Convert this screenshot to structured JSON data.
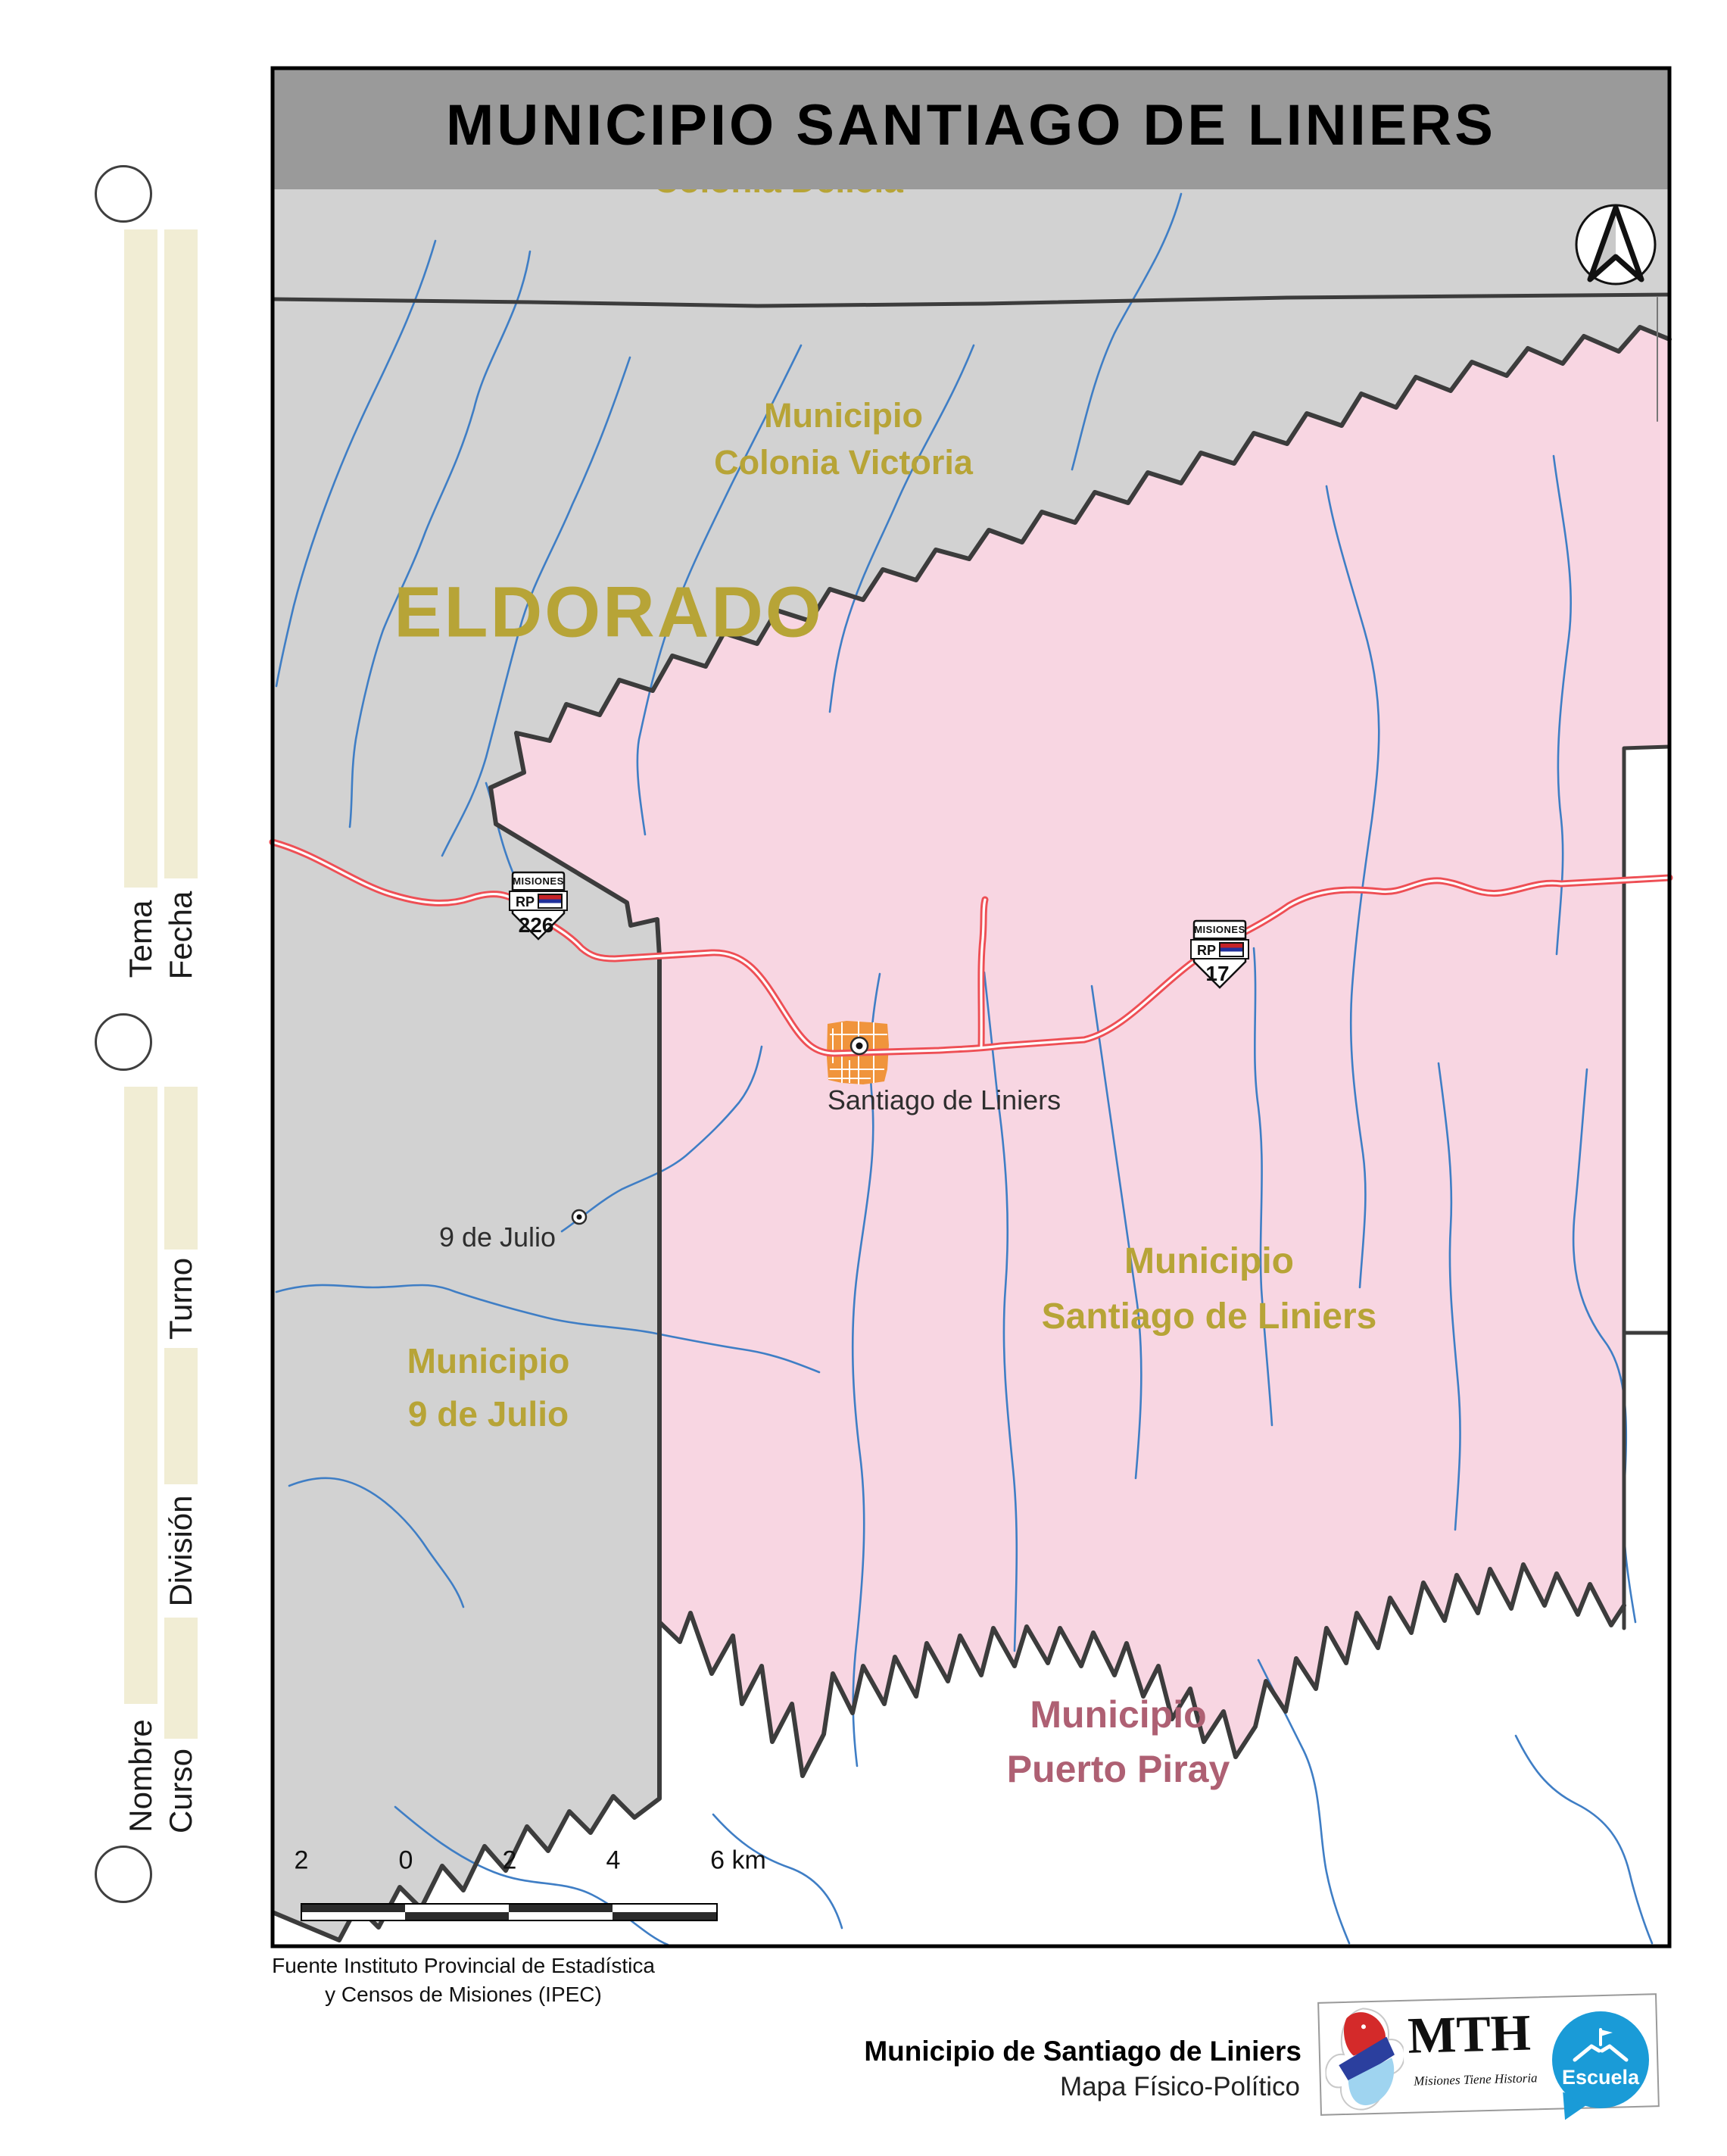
{
  "title": "MUNICIPIO SANTIAGO DE LINIERS",
  "worksheet": {
    "tema": "Tema",
    "fecha": "Fecha",
    "turno": "Turno",
    "division": "División",
    "nombre": "Nombre",
    "curso": "Curso"
  },
  "map": {
    "labels": {
      "clipped_top": "Colonia Delicia",
      "colonia_victoria": {
        "line1": "Municipio",
        "line2": "Colonia Victoria"
      },
      "eldorado": "ELDORADO",
      "santiago_region": {
        "line1": "Municipio",
        "line2": "Santiago de Liniers"
      },
      "nueve_julio_region": {
        "line1": "Municipio",
        "line2": "9 de Julio"
      },
      "puerto_piray_region": {
        "line1": "Municipio",
        "line2": "Puerto Piray"
      },
      "town_santiago": "Santiago de Liniers",
      "town_nueve_julio": "9 de Julio"
    },
    "shields": [
      {
        "region": "MISIONES",
        "type": "RP",
        "number": "226"
      },
      {
        "region": "MISIONES",
        "type": "RP",
        "number": "17"
      }
    ],
    "scale": {
      "ticks": [
        "2",
        "0",
        "2",
        "4",
        "6 km"
      ]
    },
    "source": {
      "line1": "Fuente Instituto Provincial de Estadística",
      "line2": "y Censos de Misiones (IPEC)"
    }
  },
  "footer": {
    "title": "Municipio de Santiago de Liniers",
    "subtitle": "Mapa Físico-Político",
    "mth": {
      "name": "MTH",
      "tagline": "Misiones Tiene Historia"
    },
    "escuela": "Escuela"
  },
  "colors": {
    "title_band": "#9a9a9a",
    "land_gray": "#d2d2d2",
    "region_pink": "#f8d6e2",
    "boundary_dark": "#3c3c3c",
    "region_label_yellow": "#b7a437",
    "puerto_piray_label": "#ae6073",
    "road_red": "#ee4f55",
    "river_blue": "#3f7ec5",
    "town_orange": "#f0943c",
    "margin_beige": "#f1edd4",
    "escuela_blue": "#1a9bd7"
  }
}
